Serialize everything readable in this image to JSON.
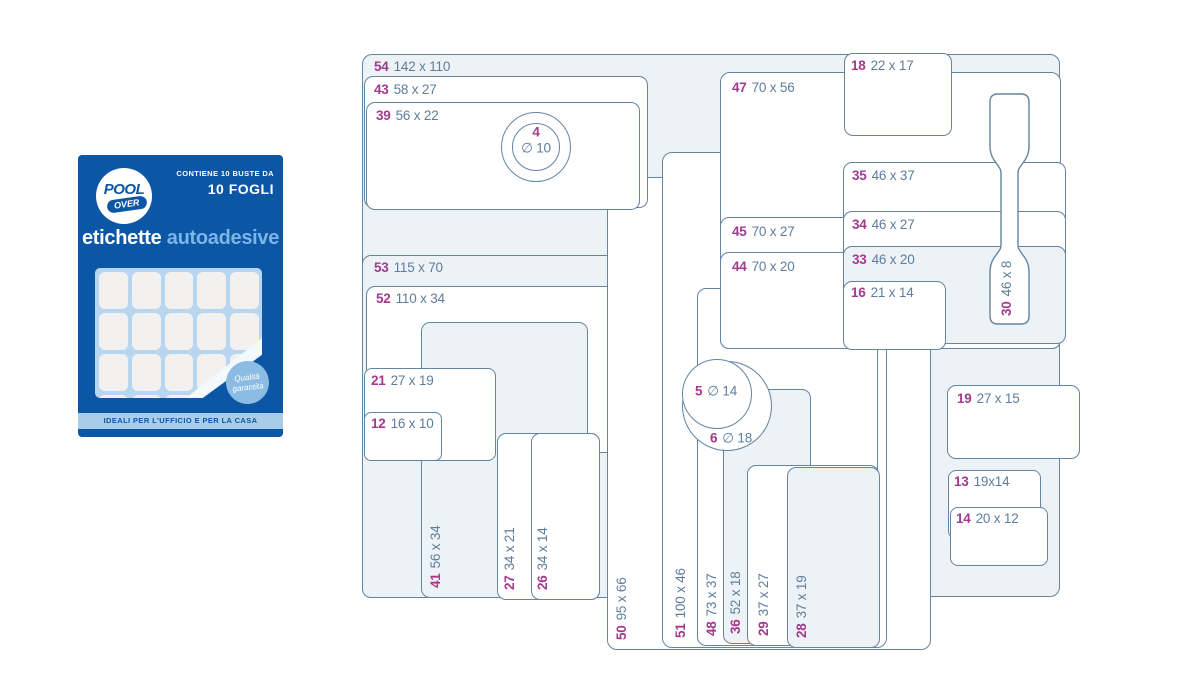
{
  "package": {
    "brand_top": "POOL",
    "brand_bottom": "OVER",
    "contains_line1": "CONTIENE 10 BUSTE DA",
    "contains_line2": "10 FOGLI",
    "title_main": "etichette",
    "title_accent": "autoadesive",
    "badge_line1": "Qualità",
    "badge_line2": "garantita",
    "footer": "IDEALI PER L'UFFICIO E PER LA CASA"
  },
  "colors": {
    "outline": "#6484a0",
    "shape_fill_light": "#edf2f7",
    "shape_fill_white": "#ffffff",
    "number_accent": "#a23a8e",
    "dimension_text": "#5e7d9b",
    "package_blue": "#0c56a6",
    "package_light_strip": "#a8cde9",
    "badge_blue": "#8cbce3",
    "sheet_blue": "#b9d6f0"
  },
  "labels": [
    {
      "id": "54",
      "size": "142 x 110"
    },
    {
      "id": "43",
      "size": "58 x 27"
    },
    {
      "id": "39",
      "size": "56 x 22"
    },
    {
      "id": "4",
      "size": "∅ 10"
    },
    {
      "id": "53",
      "size": "115 x 70"
    },
    {
      "id": "52",
      "size": "110 x 34"
    },
    {
      "id": "21",
      "size": "27 x 19"
    },
    {
      "id": "12",
      "size": "16 x 10"
    },
    {
      "id": "41",
      "size": "56 x 34"
    },
    {
      "id": "27",
      "size": "34 x 21"
    },
    {
      "id": "26",
      "size": "34 x 14"
    },
    {
      "id": "50",
      "size": "95 x 66"
    },
    {
      "id": "51",
      "size": "100 x 46"
    },
    {
      "id": "48",
      "size": "73 x 37"
    },
    {
      "id": "36",
      "size": "52 x 18"
    },
    {
      "id": "29",
      "size": "37 x 27"
    },
    {
      "id": "28",
      "size": "37 x 19"
    },
    {
      "id": "47",
      "size": "70 x 56"
    },
    {
      "id": "18",
      "size": "22 x 17"
    },
    {
      "id": "45",
      "size": "70 x 27"
    },
    {
      "id": "44",
      "size": "70 x 20"
    },
    {
      "id": "35",
      "size": "46 x 37"
    },
    {
      "id": "34",
      "size": "46 x 27"
    },
    {
      "id": "33",
      "size": "46 x 20"
    },
    {
      "id": "16",
      "size": "21 x 14"
    },
    {
      "id": "30",
      "size": "46 x 8"
    },
    {
      "id": "5",
      "size": "∅ 14"
    },
    {
      "id": "6",
      "size": "∅ 18"
    },
    {
      "id": "19",
      "size": "27 x 15"
    },
    {
      "id": "13",
      "size": "19x14"
    },
    {
      "id": "14",
      "size": "20 x 12"
    }
  ]
}
